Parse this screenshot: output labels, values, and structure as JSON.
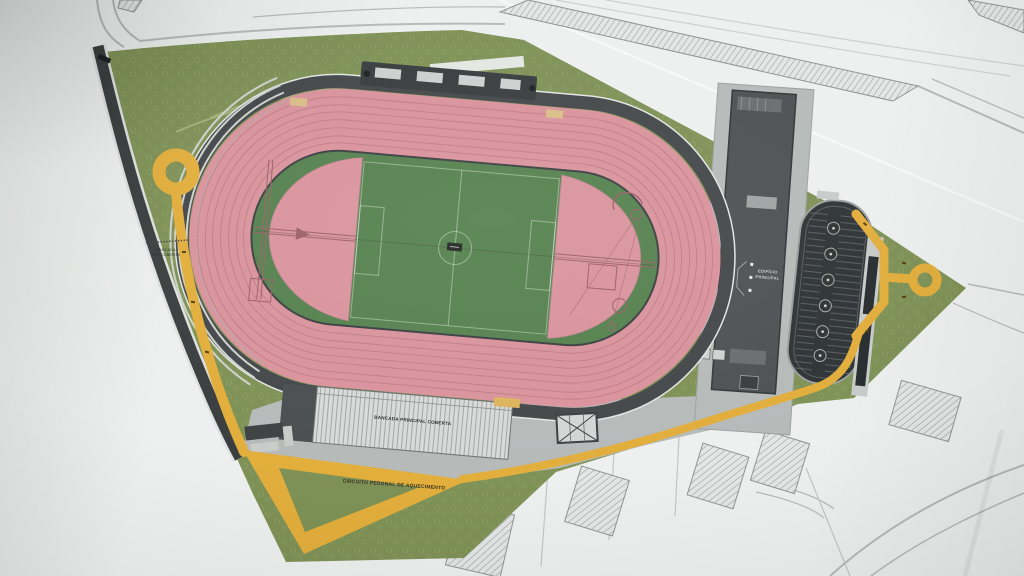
{
  "title": "Athletics stadium site plan (photographed drawing)",
  "labels": {
    "main_stand": "BANCADA PRINCIPAL COBERTA",
    "open_stand": {
      "line1": "BANCADA",
      "line2": "DESCOBERTA"
    },
    "main_building": {
      "line1": "EDIFÍCIO",
      "line2": "PRINCIPAL"
    },
    "warmup_circuit": "CIRCUITO PEDONAL DE AQUECIMENTO"
  },
  "colors": {
    "paper": "#eef0ef",
    "road_line": "#b6bab9",
    "site_green": "#7e9156",
    "grass_green": "#55814e",
    "track_pink": "#d9939c",
    "track_lane_line": "#bf7d86",
    "surround_dark": "#45484a",
    "path_yellow": "#e2ae3c",
    "concrete": "#b6bab9",
    "stand_light": "#d8dad9",
    "building_dark": "#4e5254",
    "parking_dark": "#2f3437",
    "tan": "#d8bd85"
  }
}
